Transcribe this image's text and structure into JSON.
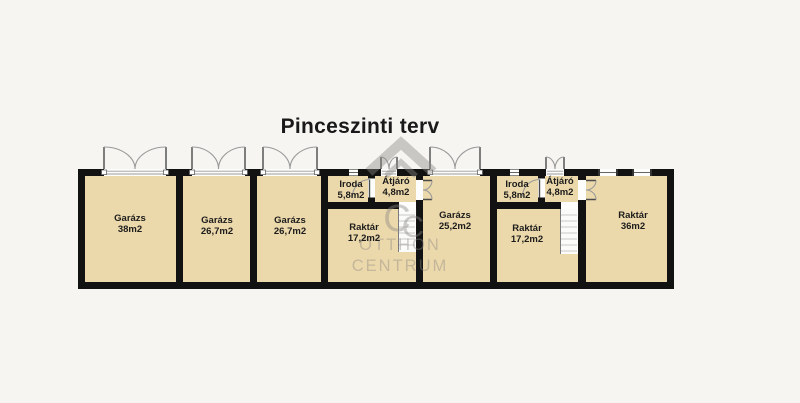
{
  "title": "Pinceszinti terv",
  "watermark": {
    "monogram_c1": "C",
    "monogram_c2": "C",
    "line1": "OTTHON",
    "line2": "CENTRUM"
  },
  "colors": {
    "background": "#f6f5f2",
    "floor": "#ecd9ab",
    "wall": "#121212",
    "door-arc": "#9a9a9a",
    "door-leaf": "#4c4c4c",
    "stair-fill": "#fbfbfa",
    "stair-line": "#c9c9c6",
    "label-text": "#1c1c1c",
    "watermark-gray": "#8b8884",
    "title-text": "#191919"
  },
  "rooms": [
    {
      "name": "Garázs",
      "area": "38m2"
    },
    {
      "name": "Garázs",
      "area": "26,7m2"
    },
    {
      "name": "Garázs",
      "area": "26,7m2"
    },
    {
      "name": "Iroda",
      "area": "5,8m2"
    },
    {
      "name": "Átjáró",
      "area": "4,8m2"
    },
    {
      "name": "Raktár",
      "area": "17,2m2"
    },
    {
      "name": "Garázs",
      "area": "25,2m2"
    },
    {
      "name": "Iroda",
      "area": "5,8m2"
    },
    {
      "name": "Átjáró",
      "area": "4,8m2"
    },
    {
      "name": "Raktár",
      "area": "17,2m2"
    },
    {
      "name": "Raktár",
      "area": "36m2"
    }
  ]
}
